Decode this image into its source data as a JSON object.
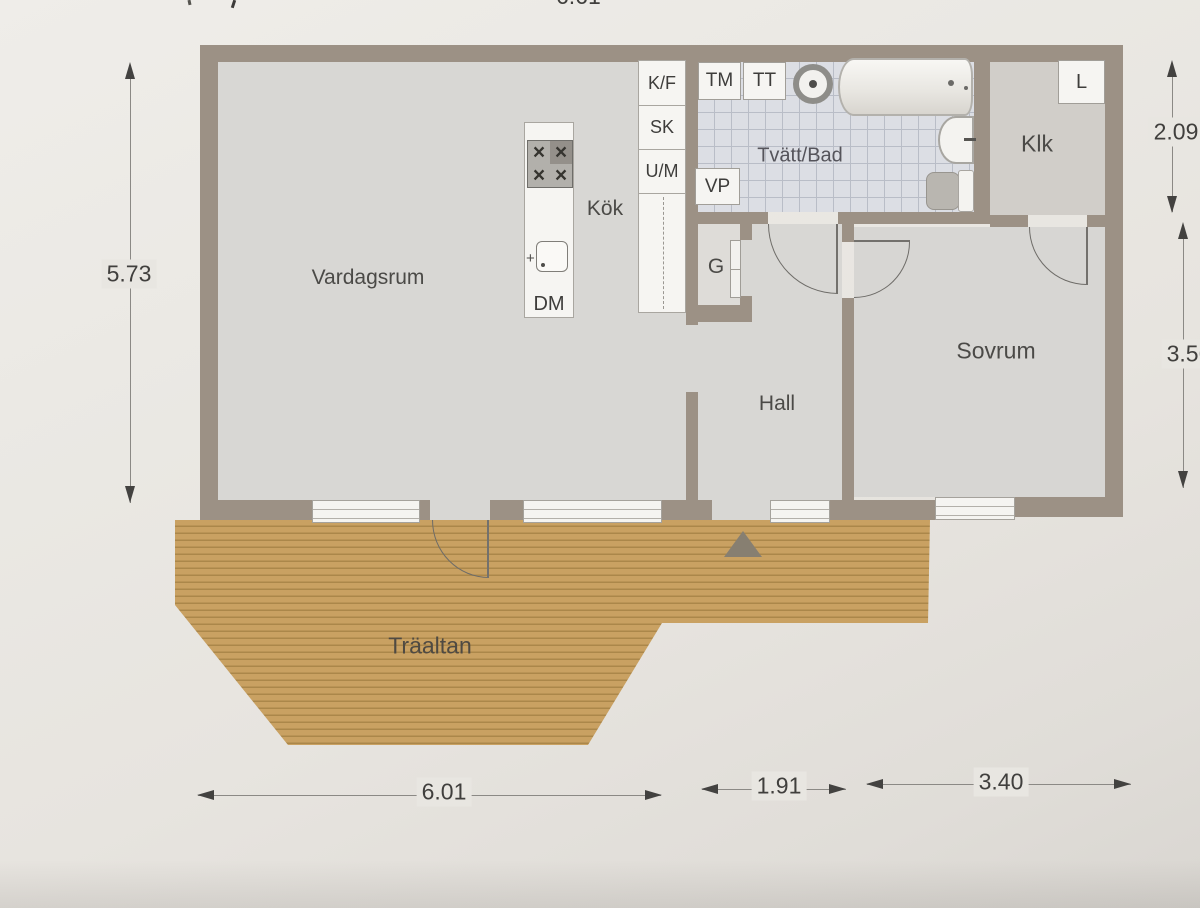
{
  "document": {
    "type": "floor-plan",
    "language": "sv"
  },
  "rooms": {
    "vardagsrum": "Vardagsrum",
    "kok": "Kök",
    "tvatt_bad": "Tvätt/Bad",
    "hall": "Hall",
    "sovrum": "Sovrum",
    "klk": "Klk",
    "traaltan": "Träaltan",
    "garderob": "G"
  },
  "fixtures": {
    "kyl_frys": "K/F",
    "skafferi": "SK",
    "ugn_micro": "U/M",
    "diskmaskin": "DM",
    "tvattmaskin": "TM",
    "torktumlare": "TT",
    "varmepump": "VP",
    "linne": "L"
  },
  "dimensions": {
    "left_height": "5.73",
    "right_upper": "2.09",
    "right_lower": "3.56",
    "bottom_left": "6.01",
    "bottom_middle": "1.91",
    "bottom_right": "3.40",
    "top_partial": "6.61"
  },
  "colors": {
    "paper": "#e9e7e2",
    "wall": "#9c9185",
    "floor": "#d8d7d4",
    "tile_floor": "#dcdee4",
    "tile_line": "#b9bdc7",
    "deck_wood": "#c9a162",
    "deck_plank_line": "#a5813f",
    "fixture_white": "#f6f5f2",
    "dimension_text": "#403f3d"
  }
}
